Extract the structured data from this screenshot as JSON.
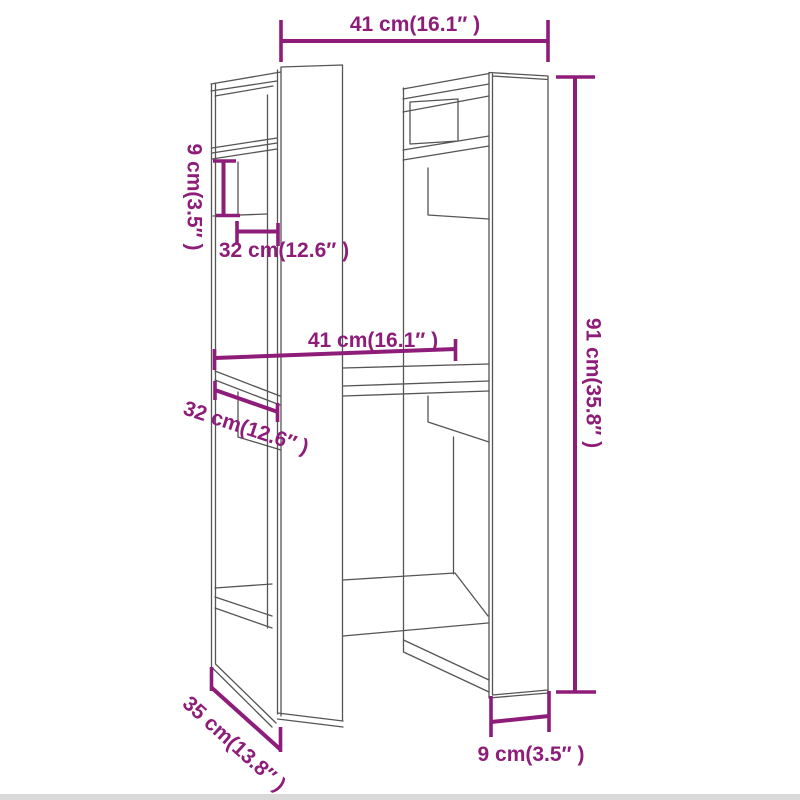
{
  "figure": {
    "type": "furniture-dimension-diagram",
    "subject": "book cabinet / room divider technical line drawing",
    "colors": {
      "dimension_accent": "#8d1d79",
      "line_art": "#555555",
      "background": "#ffffff",
      "bottom_strip": "#d9d9d9"
    },
    "dimensions": {
      "top_width": "41 cm(16.1″ )",
      "left_gap_height": "9 cm(3.5″ )",
      "upper_inner_depth": "32 cm(12.6″ )",
      "middle_width": "41 cm(16.1″ )",
      "lower_inner_depth": "32 cm(12.6″ )",
      "overall_height": "91 cm(35.8″ )",
      "base_depth": "35 cm(13.8″ )",
      "base_panel_width": "9 cm(3.5″ )"
    }
  }
}
